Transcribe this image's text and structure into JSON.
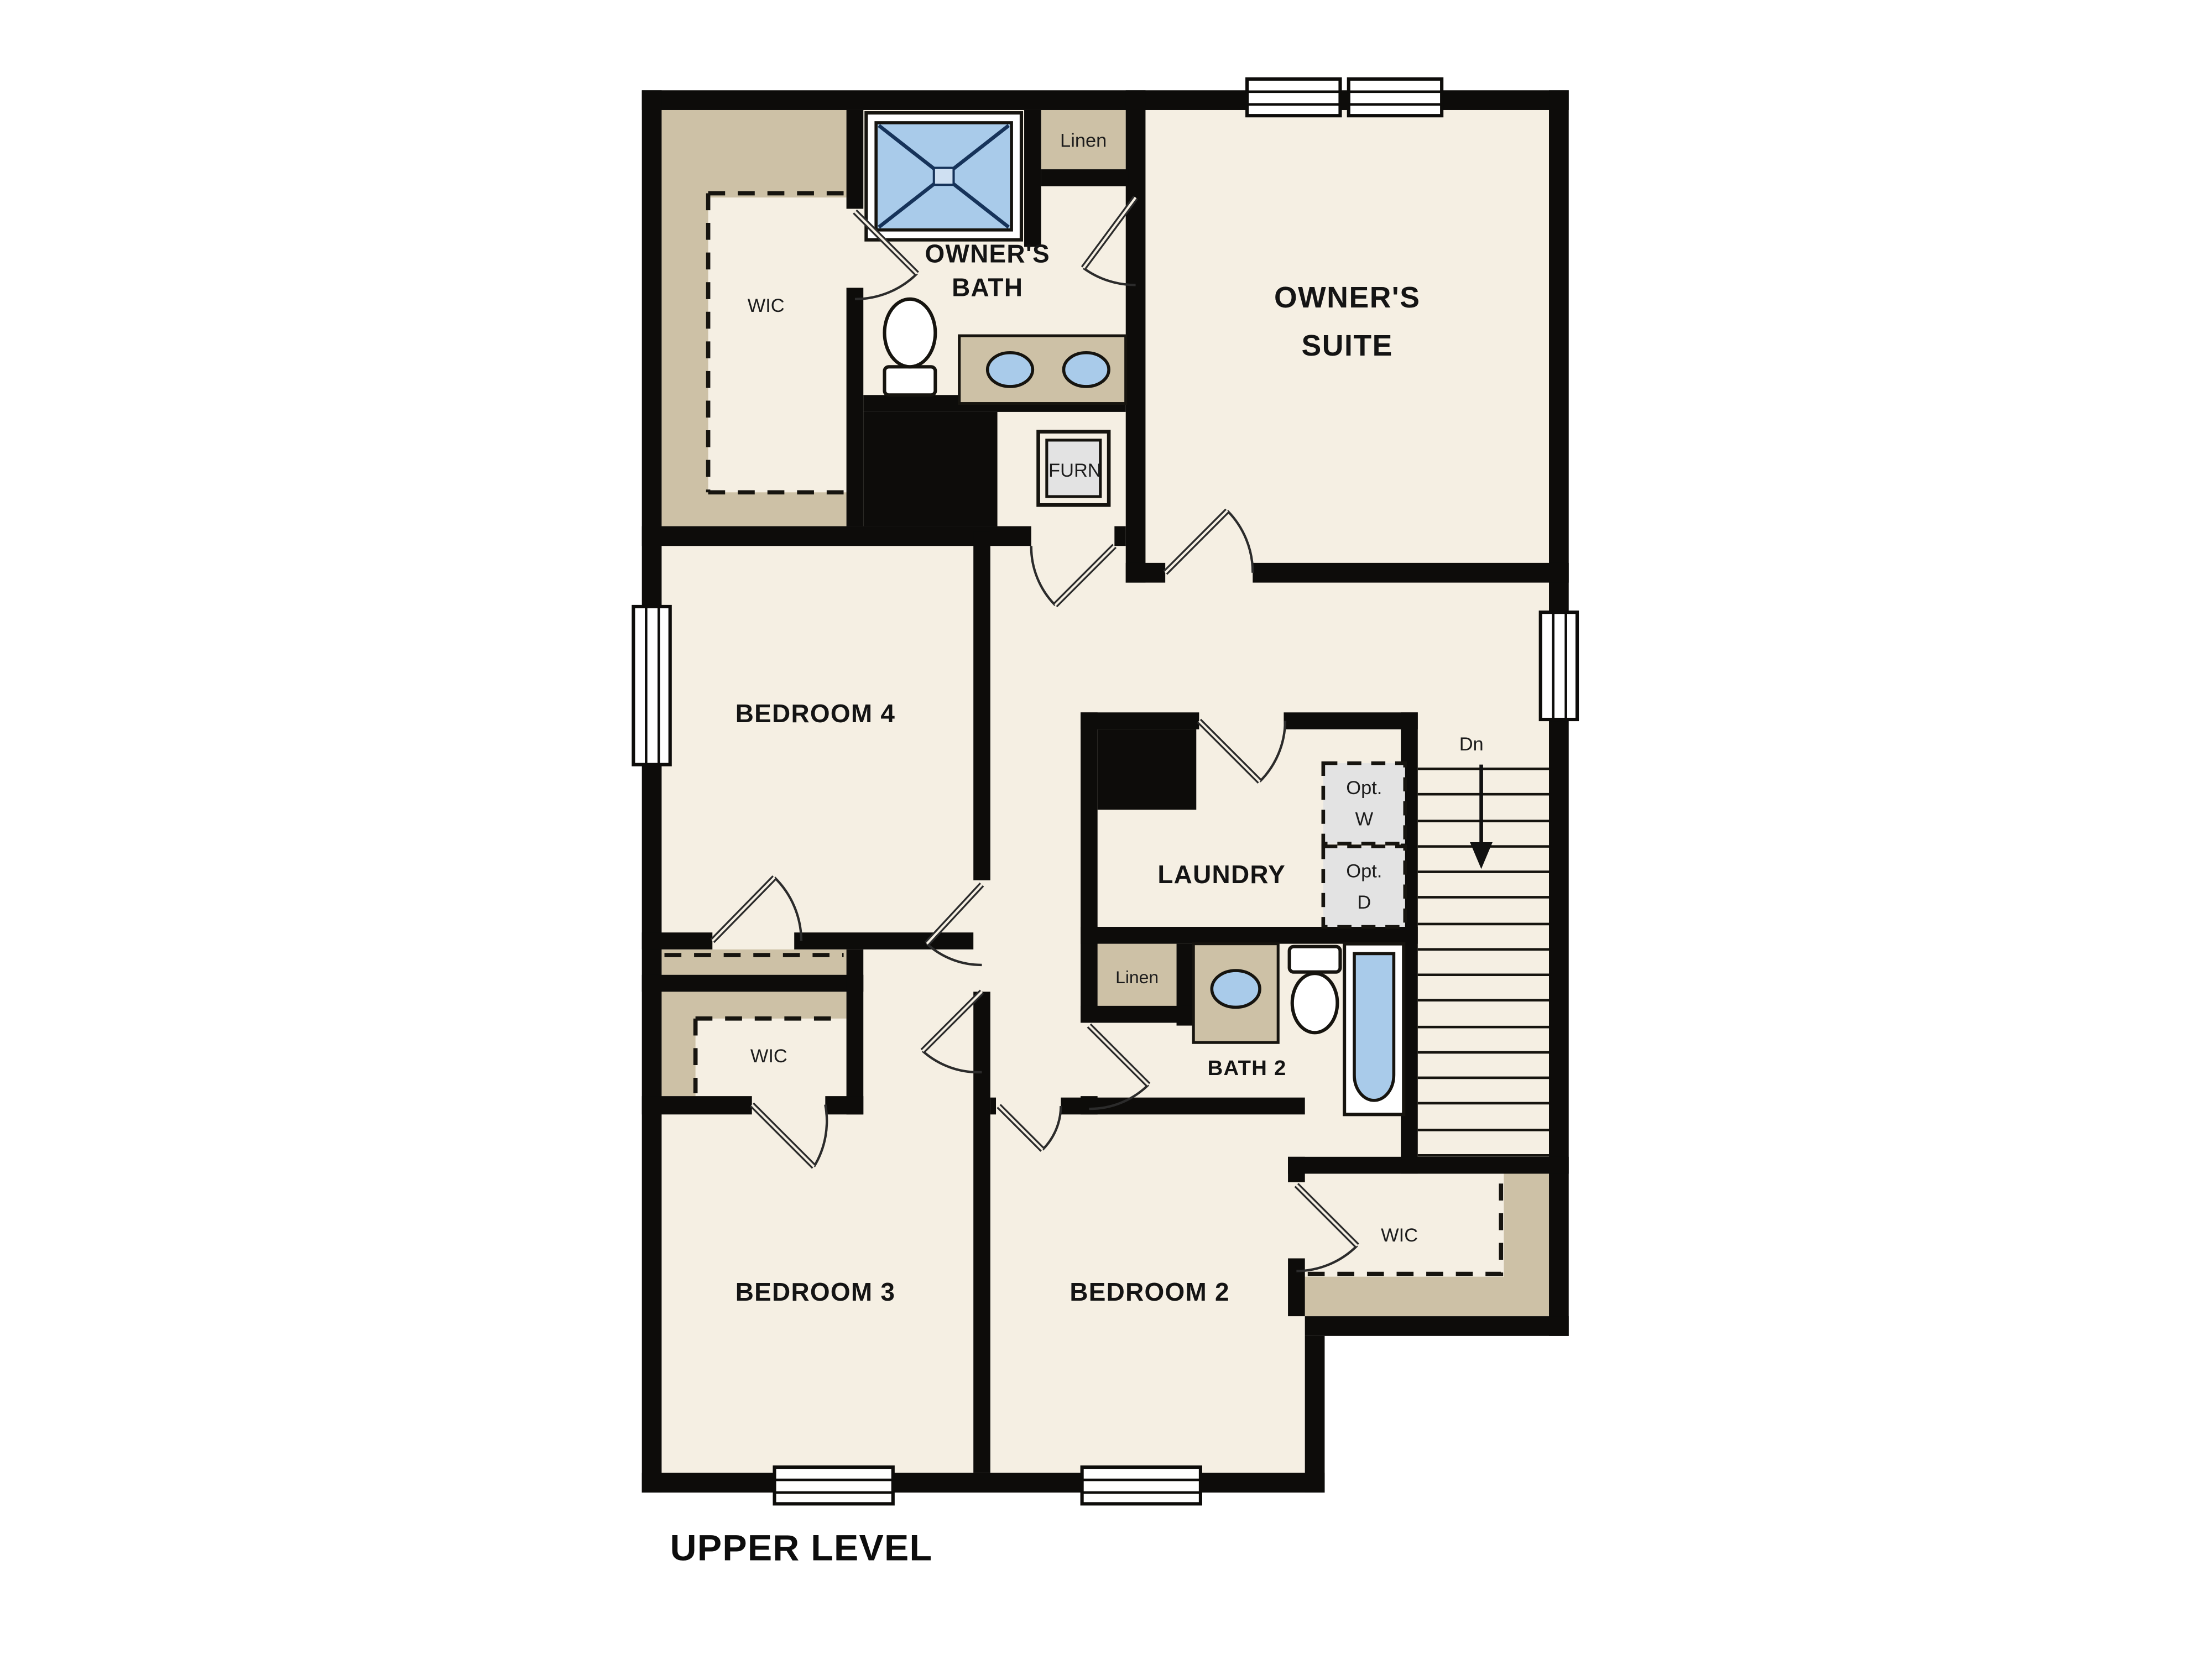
{
  "title": "UPPER LEVEL",
  "colors": {
    "floor": "#f5efe3",
    "wall": "#0d0c0a",
    "closet_tan": "#cdc1a6",
    "fixture_blue": "#a9cbea",
    "appliance_gray": "#e3e3e3",
    "background": "#ffffff"
  },
  "rooms": {
    "owners_suite": {
      "line1": "OWNER'S",
      "line2": "SUITE"
    },
    "owners_bath": {
      "line1": "OWNER'S",
      "line2": "BATH"
    },
    "bedroom_4": {
      "label": "BEDROOM 4"
    },
    "bedroom_3": {
      "label": "BEDROOM 3"
    },
    "bedroom_2": {
      "label": "BEDROOM 2"
    },
    "laundry": {
      "label": "LAUNDRY"
    },
    "bath_2": {
      "label": "BATH 2"
    }
  },
  "closets": {
    "owners_wic": {
      "label": "WIC"
    },
    "bedroom3_wic": {
      "label": "WIC"
    },
    "bedroom2_wic": {
      "label": "WIC"
    },
    "linen_upper": {
      "label": "Linen"
    },
    "linen_bath2": {
      "label": "Linen"
    }
  },
  "fixtures": {
    "furnace": {
      "label": "FURN"
    },
    "stairs_direction": {
      "label": "Dn"
    },
    "optional_washer": {
      "line1": "Opt.",
      "line2": "W"
    },
    "optional_dryer": {
      "line1": "Opt.",
      "line2": "D"
    }
  }
}
